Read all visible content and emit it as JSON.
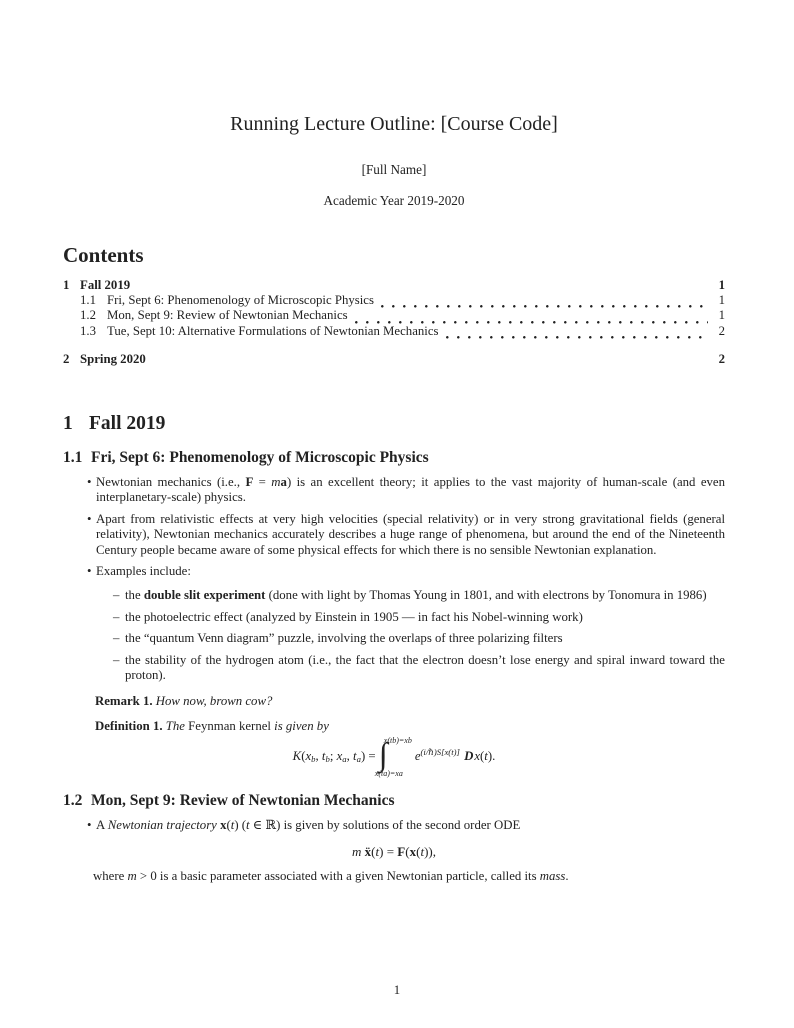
{
  "glyphs": {
    "bullet": "•",
    "dash": "–"
  },
  "header": {
    "title": "Running Lecture Outline: [Course Code]",
    "author": "[Full Name]",
    "date": "Academic Year 2019-2020"
  },
  "toc": {
    "heading": "Contents",
    "entries": [
      {
        "num": "1",
        "label": "Fall 2019",
        "page": "1"
      },
      {
        "num": "1.1",
        "label": "Fri, Sept 6: Phenomenology of Microscopic Physics",
        "page": "1"
      },
      {
        "num": "1.2",
        "label": "Mon, Sept 9: Review of Newtonian Mechanics",
        "page": "1"
      },
      {
        "num": "1.3",
        "label": "Tue, Sept 10: Alternative Formulations of Newtonian Mechanics",
        "page": "2"
      },
      {
        "num": "2",
        "label": "Spring 2020",
        "page": "2"
      }
    ]
  },
  "sections": {
    "fall": {
      "num": "1",
      "title": "Fall 2019"
    },
    "s11": {
      "num": "1.1",
      "title": "Fri, Sept 6: Phenomenology of Microscopic Physics"
    },
    "s12": {
      "num": "1.2",
      "title": "Mon, Sept 9: Review of Newtonian Mechanics"
    }
  },
  "content": {
    "b1": [
      {
        "t": "Newtonian mechanics (i.e., "
      },
      {
        "t": "F",
        "c": "b"
      },
      {
        "t": " = "
      },
      {
        "t": "m",
        "c": "i"
      },
      {
        "t": "a",
        "c": "b"
      },
      {
        "t": ") is an excellent theory; it applies to the vast majority of human-scale (and even interplanetary-scale) physics."
      }
    ],
    "b2": [
      {
        "t": "Apart from relativistic effects at very high velocities (special relativity) or in very strong gravitational fields (general relativity), Newtonian mechanics accurately describes a huge range of phenomena, but around the end of the Nineteenth Century people became aware of some physical effects for which there is no sensible Newtonian explanation."
      }
    ],
    "b3": [
      {
        "t": "Examples include:"
      }
    ],
    "d1": [
      {
        "t": "the "
      },
      {
        "t": "double slit experiment",
        "c": "b"
      },
      {
        "t": " (done with light by Thomas Young in 1801, and with electrons by Tonomura in 1986)"
      }
    ],
    "d2": [
      {
        "t": "the photoelectric effect (analyzed by Einstein in 1905 — in fact his Nobel-winning work)"
      }
    ],
    "d3": [
      {
        "t": "the “quantum Venn diagram” puzzle, involving the overlaps of three polarizing filters"
      }
    ],
    "d4": [
      {
        "t": "the stability of the hydrogen atom (i.e., the fact that the electron doesn’t lose energy and spiral inward toward the proton)."
      }
    ],
    "remark": [
      {
        "t": "Remark 1.",
        "c": "b"
      },
      {
        "t": " "
      },
      {
        "t": "How now, brown cow?",
        "c": "i"
      }
    ],
    "definition": [
      {
        "t": "Definition 1.",
        "c": "b"
      },
      {
        "t": " "
      },
      {
        "t": "The",
        "c": "i"
      },
      {
        "t": " Feynman kernel "
      },
      {
        "t": "is given by",
        "c": "i"
      }
    ],
    "eq_feynman": [
      {
        "t": "K",
        "c": "i"
      },
      {
        "t": "("
      },
      {
        "t": "x",
        "c": "i"
      },
      {
        "t": "b",
        "c": "i sub"
      },
      {
        "t": ", "
      },
      {
        "t": "t",
        "c": "i"
      },
      {
        "t": "b",
        "c": "i sub"
      },
      {
        "t": "; "
      },
      {
        "t": "x",
        "c": "i"
      },
      {
        "t": "a",
        "c": "i sub"
      },
      {
        "t": ", "
      },
      {
        "t": "t",
        "c": "i"
      },
      {
        "t": "a",
        "c": "i sub"
      },
      {
        "t": ") = "
      },
      {
        "t": "∫",
        "c": "int"
      },
      {
        "top": "x(tb)=xb",
        "bottom": "x(ta)=xa"
      },
      {
        "t": "e",
        "c": "i"
      },
      {
        "t": "(i/ℏ)S[x(t)]",
        "c": "i sup"
      },
      {
        "t": " "
      },
      {
        "t": "D",
        "c": "scr"
      },
      {
        "t": "x",
        "c": "i"
      },
      {
        "t": "("
      },
      {
        "t": "t",
        "c": "i"
      },
      {
        "t": ")."
      }
    ],
    "b12": [
      {
        "t": "A "
      },
      {
        "t": "Newtonian trajectory",
        "c": "i"
      },
      {
        "t": " "
      },
      {
        "t": "x",
        "c": "b"
      },
      {
        "t": "("
      },
      {
        "t": "t",
        "c": "i"
      },
      {
        "t": ") ("
      },
      {
        "t": "t",
        "c": "i"
      },
      {
        "t": " ∈ ℝ) is given by solutions of the second order ODE"
      }
    ],
    "eq_newton": [
      {
        "t": "m",
        "c": "i"
      },
      {
        "t": " "
      },
      {
        "t": "ẍ",
        "c": "b"
      },
      {
        "t": "("
      },
      {
        "t": "t",
        "c": "i"
      },
      {
        "t": ") = "
      },
      {
        "t": "F",
        "c": "b"
      },
      {
        "t": "("
      },
      {
        "t": "x",
        "c": "b"
      },
      {
        "t": "("
      },
      {
        "t": "t",
        "c": "i"
      },
      {
        "t": ")),"
      }
    ],
    "massnote": [
      {
        "t": "where "
      },
      {
        "t": "m",
        "c": "i"
      },
      {
        "t": " > 0 is a basic parameter associated with a given Newtonian particle, called its "
      },
      {
        "t": "mass",
        "c": "i"
      },
      {
        "t": "."
      }
    ]
  },
  "footer": {
    "page_number": "1"
  }
}
